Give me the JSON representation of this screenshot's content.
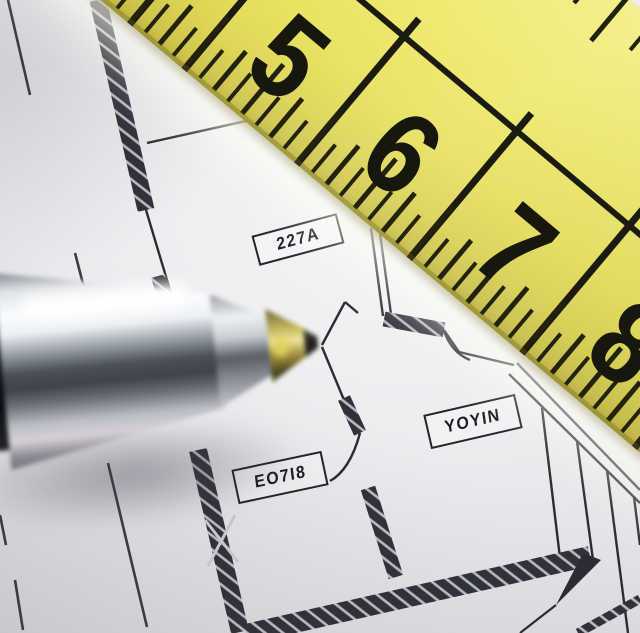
{
  "ruler": {
    "numbers": [
      "5",
      "6",
      "7",
      "8"
    ],
    "body_color": "#e7e15a",
    "marking_color": "#1c1b11"
  },
  "floor_plan": {
    "room_labels": [
      {
        "text": "227A"
      },
      {
        "text": "YOYIN"
      },
      {
        "text": "EO7I8"
      }
    ],
    "line_color": "#2b2b33",
    "wall_fill": "#30313a"
  },
  "pen": {
    "barrel_color": "#9aa0a8",
    "grip_color": "#15161b",
    "tip_color": "#c8ba62"
  }
}
